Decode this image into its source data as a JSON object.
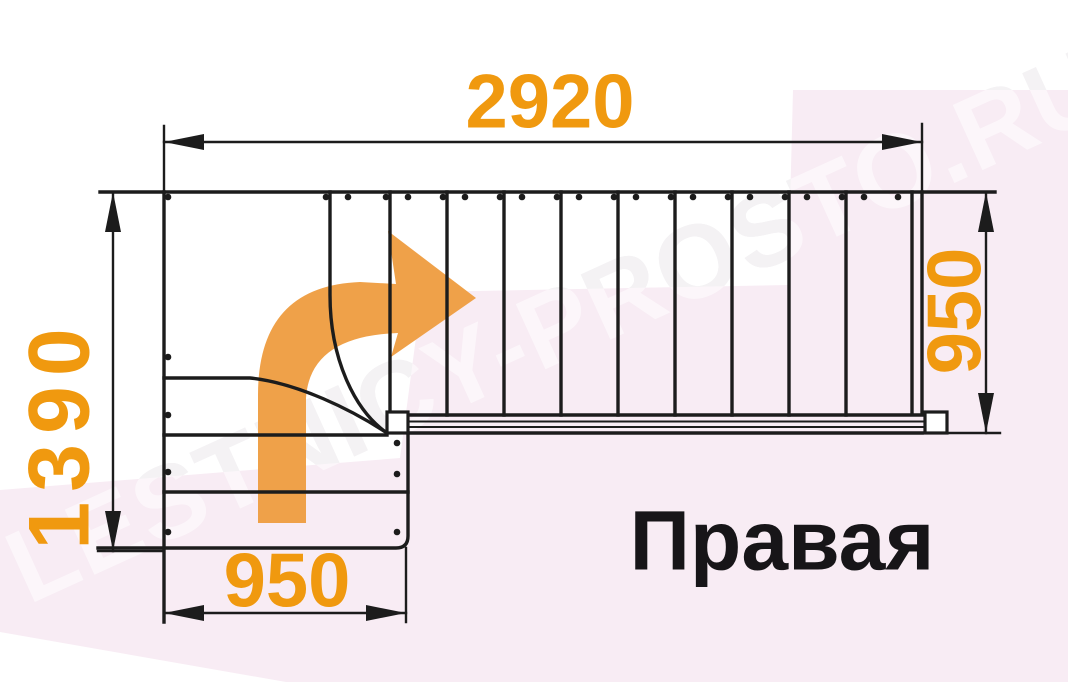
{
  "watermark": {
    "text": "LESTNICY-PROSTO.RU"
  },
  "labels": {
    "orientation": "Правая"
  },
  "dimensions": {
    "top_length": "2920",
    "left_width": "1390",
    "right_width": "950",
    "bottom_width": "950"
  },
  "colors": {
    "dimension_text_orange": "#F0990F",
    "arrow_orange": "#EFA149",
    "line_black": "#1C1C1C",
    "backdrop_pink": "#F8ECF4"
  },
  "icons": {
    "direction_arrow": "curved-right-turn-arrow"
  }
}
